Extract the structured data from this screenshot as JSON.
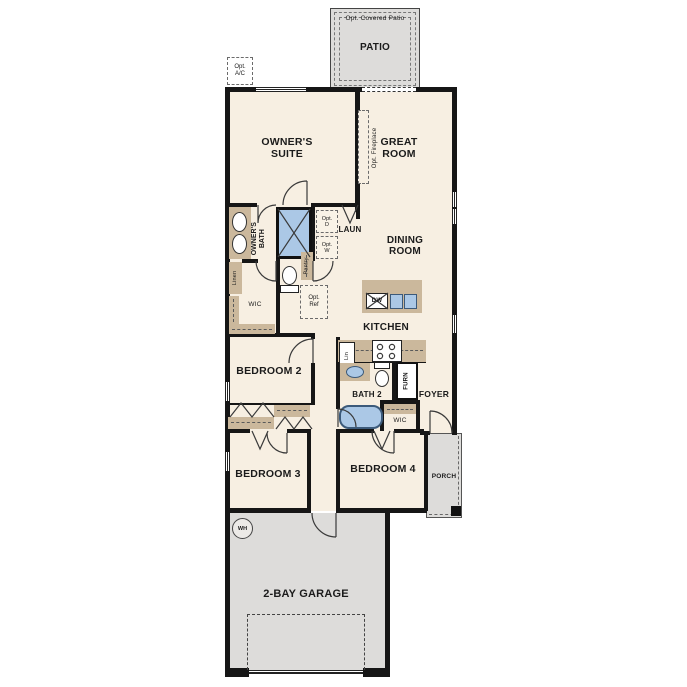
{
  "colors": {
    "floor": "#f7efe2",
    "hard": "#dddcda",
    "counter": "#cbb89c",
    "fixture": "#abc8e6",
    "fixtureBorder": "#3c5a7a",
    "wall": "#161616",
    "line": "#3a3a3a"
  },
  "labels": {
    "patio": "PATIO",
    "opt_covered_patio": "Opt. Covered Patio",
    "opt_ac": "Opt. A/C",
    "owners_suite": "OWNER'S SUITE",
    "great_room": "GREAT ROOM",
    "opt_fireplace": "Opt. Fireplace",
    "owners_bath": "OWNER'S BATH",
    "linen": "Linen",
    "opt_d": "Opt. D",
    "opt_w": "Opt. W",
    "laun": "LAUN",
    "pantry": "Pantry",
    "wic_owner": "WIC",
    "opt_ref": "Opt. Ref",
    "dining_room": "DINING ROOM",
    "dw": "DW",
    "kitchen": "KITCHEN",
    "lin": "Lin",
    "bath2": "BATH 2",
    "furn": "FURN",
    "foyer": "FOYER",
    "wic_hall": "WIC",
    "bedroom2": "BEDROOM 2",
    "bedroom3": "BEDROOM 3",
    "bedroom4": "BEDROOM 4",
    "porch": "PORCH",
    "wh": "WH",
    "garage": "2-BAY GARAGE"
  }
}
